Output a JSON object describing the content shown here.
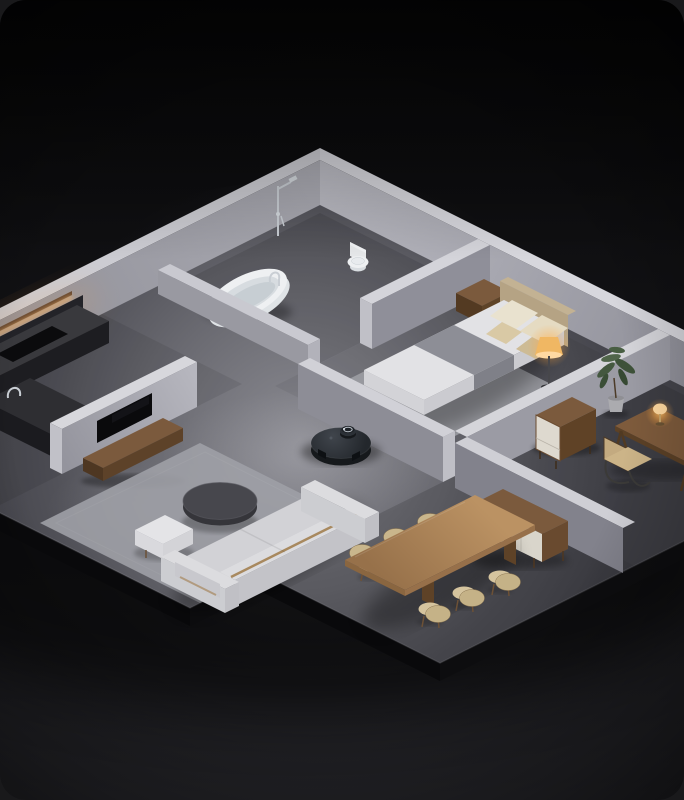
{
  "scene": {
    "type": "isometric-apartment-render",
    "time_of_day": "night",
    "subject": "robot vacuum in the hallway of a miniature apartment cutaway"
  },
  "labels": {
    "apartment": "Miniature apartment cutaway, isometric night scene",
    "bathroom": "Bathroom",
    "kitchen": "Kitchen",
    "living_room": "Living room",
    "bedroom": "Bedroom",
    "study": "Study",
    "dining": "Dining area",
    "hallway": "Hallway",
    "robot_vacuum": "Robot vacuum",
    "lidar": "LiDAR turret",
    "bathtub": "Freestanding bathtub",
    "shower": "Shower column",
    "toilet": "Toilet",
    "kitchen_counter": "Kitchen counter",
    "cooktop": "Cooktop",
    "kitchen_island": "Kitchen island",
    "under_cabinet_light": "Under-cabinet light strip",
    "tv": "Wall-mounted TV",
    "tv_console": "TV console",
    "sofa": "Sofa",
    "ottoman": "Ottoman",
    "coffee_table": "Coffee table",
    "living_rug": "Living room rug",
    "bed": "Double bed",
    "nightstand": "Nightstand",
    "floor_lamp": "Floor lamp",
    "bedroom_rug": "Bedroom rug",
    "cabinet": "Storage cabinet",
    "plant": "Potted plant",
    "desk": "Desk",
    "desk_lamp": "Desk lamp",
    "desk_chair": "Desk chair",
    "dining_table": "Dining table",
    "dining_chair": "Dining chair",
    "sideboard": "Sideboard"
  },
  "colors": {
    "page_bg": "#19191b",
    "card_top": "#070708",
    "card_mid": "#131316",
    "card_bottom": "#222226",
    "wall_top": "#d7d7dd",
    "wall_lit": "#b7b7bf",
    "wall_shade": "#8d8d96",
    "floor_light": "#8a8a91",
    "floor_dark": "#44444b",
    "slab_side": "#0c0c0e",
    "wood": "#7b5a3d",
    "wood_dark": "#5d4229",
    "oak": "#b0895c",
    "beige": "#d9c8a2",
    "fixture_white": "#eef0f2",
    "duvet": "#e2e2e5",
    "blanket": "#8d8e96",
    "sofa": "#d2d2d6",
    "rug": "#9fa0a6",
    "robot_body": "#31363c",
    "robot_dark": "#16191c",
    "tv": "#0a0a0c",
    "amber": "#ffb35c",
    "lamp_glow": "#ffbe64",
    "chrome": "#c9ced4",
    "leaf": "#44583f"
  }
}
